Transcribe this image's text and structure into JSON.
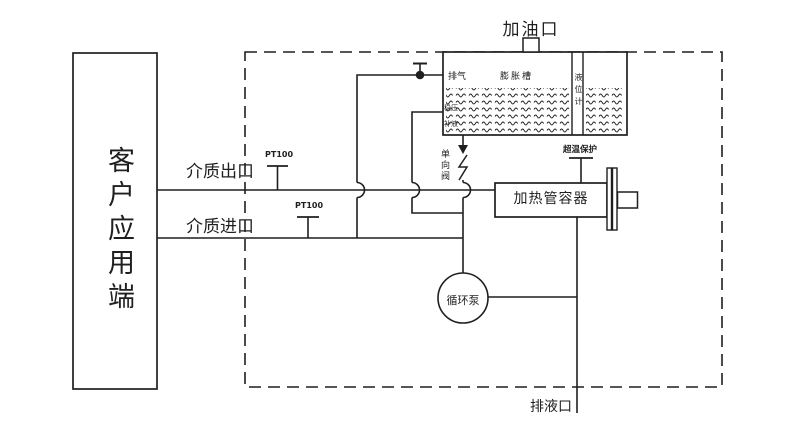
{
  "diagram": {
    "title_area": {
      "oil_fill_port": "加油口"
    },
    "customer_box": {
      "label": "客户应用端"
    },
    "expansion_tank": {
      "name": "膨胀槽",
      "vent": "排气",
      "level_gauge": "液位计",
      "pressure_stabilize": "稳压",
      "liquid_makeup": "补液"
    },
    "valves": {
      "check_valve": "单向阀"
    },
    "pipes": {
      "medium_outlet": "介质出口",
      "medium_inlet": "介质进口"
    },
    "sensors": {
      "pt100_outlet": "PT100",
      "pt100_inlet": "PT100",
      "overtemp_protection": "超温保护"
    },
    "equipment": {
      "heater_vessel": "加热管容器",
      "circulation_pump": "循环泵"
    },
    "drain": {
      "drain_port": "排液口"
    },
    "colors": {
      "line": "#1f1f1f",
      "background": "#ffffff"
    }
  }
}
